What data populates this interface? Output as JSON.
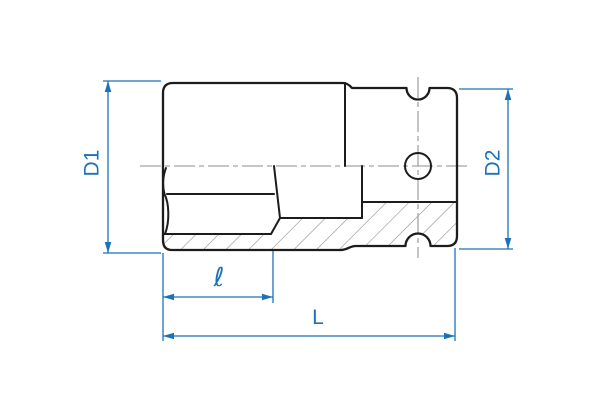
{
  "drawing": {
    "kind": "engineering-dimension-drawing",
    "subject": "deep impact socket, half-section side view",
    "labels": {
      "d1": "D1",
      "d2": "D2",
      "ell": "ℓ",
      "length": "L"
    },
    "colors": {
      "dimension_blue": "#1b72b9",
      "outline_ink": "#1c1c1c",
      "centerline_gray": "#a3a3a3",
      "hatch_gray": "#8f8f8f",
      "background": "#ffffff"
    }
  }
}
